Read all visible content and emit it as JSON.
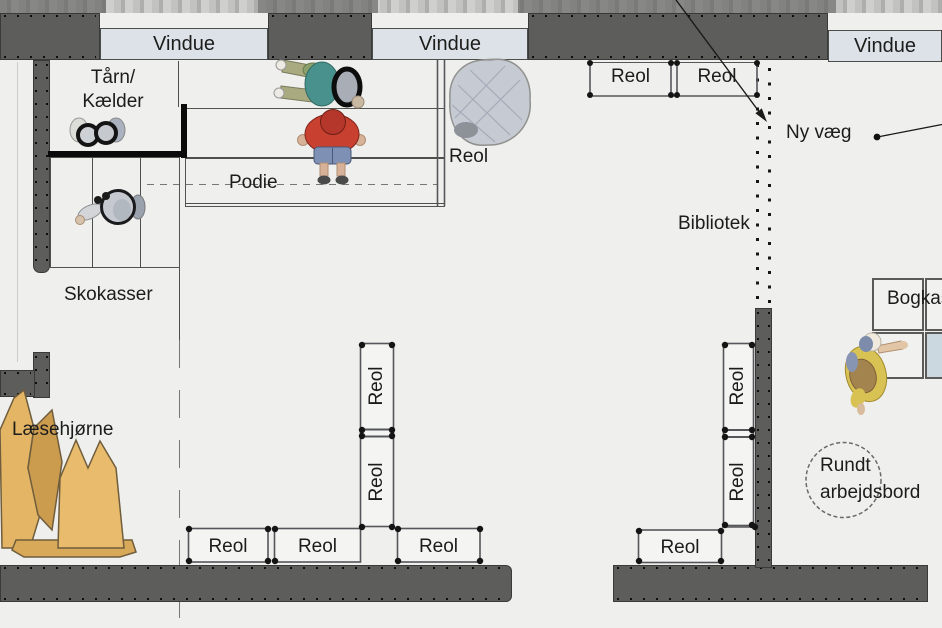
{
  "windows": {
    "w1": "Vindue",
    "w2": "Vindue",
    "w3": "Vindue"
  },
  "areas": {
    "tower_line1": "Tårn/",
    "tower_line2": "Kælder",
    "podium": "Podie",
    "shoe_boxes": "Skokasser",
    "library": "Bibliotek",
    "new_wall": "Ny væg",
    "reading_corner": "Læsehjørne",
    "book_boxes": "Bogkasser",
    "round_table_line1": "Rundt",
    "round_table_line2": "arbejdsbord"
  },
  "shelves": {
    "top_right_1": "Reol",
    "top_right_2": "Reol",
    "podium_side": "Reol",
    "mid_col_1": "Reol",
    "mid_col_2": "Reol",
    "right_col_1": "Reol",
    "right_col_2": "Reol",
    "bottom_1": "Reol",
    "bottom_2": "Reol",
    "bottom_3": "Reol",
    "right_bottom": "Reol"
  },
  "colors": {
    "wall": "#5d5d5b",
    "window_fill": "#dce2e8",
    "floor": "#efefed",
    "beanbag_yellow": "#e3b565",
    "shelf_line": "#55565a",
    "figure_red": "#c8402f",
    "figure_teal": "#49918c"
  }
}
